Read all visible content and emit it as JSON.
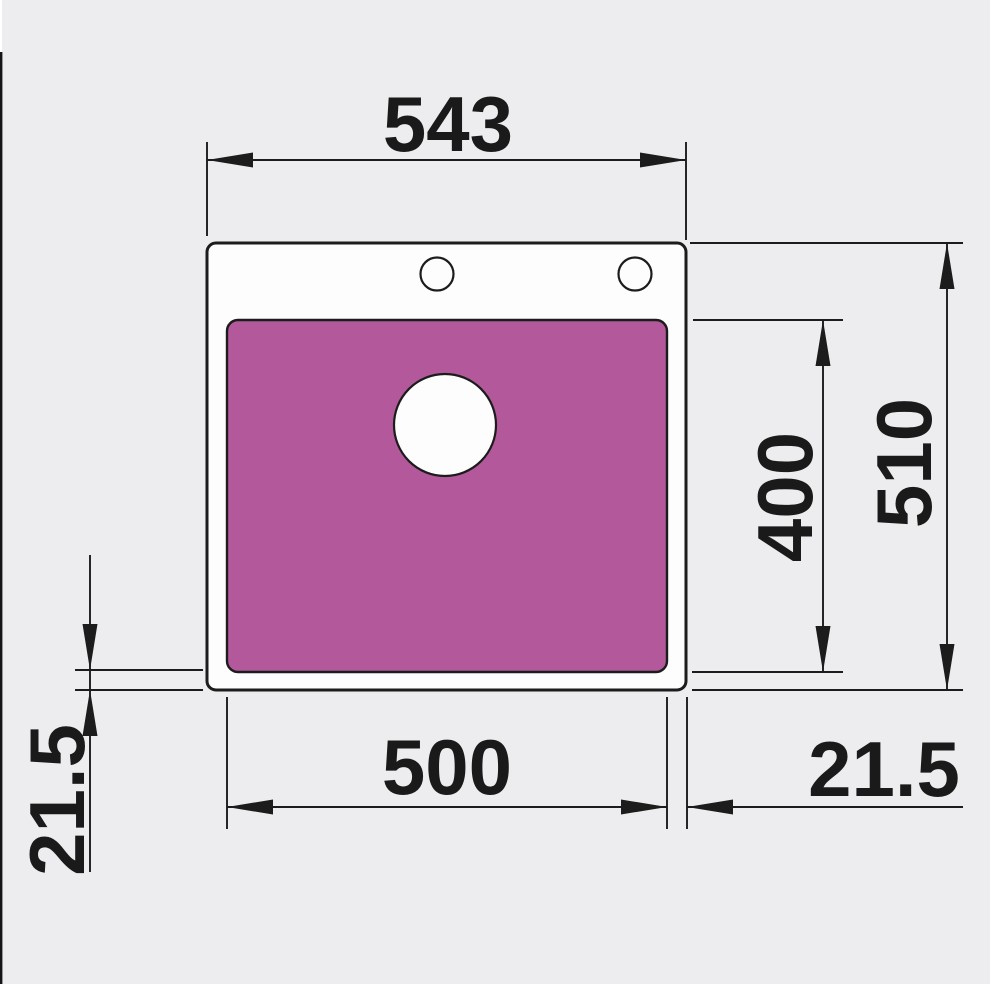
{
  "diagram": {
    "title": "Sink dimension drawing, top view",
    "dimensions": {
      "overall_width": "543",
      "overall_depth": "510",
      "bowl_depth": "400",
      "bowl_width": "500",
      "rim_right": "21.5",
      "rim_left": "21.5"
    },
    "colors": {
      "background": "#ededef",
      "sink_fill": "#fdfdfd",
      "bowl_fill": "#b2589b",
      "hole_fill": "#fdfdfd",
      "line": "#1c1c1c"
    }
  }
}
